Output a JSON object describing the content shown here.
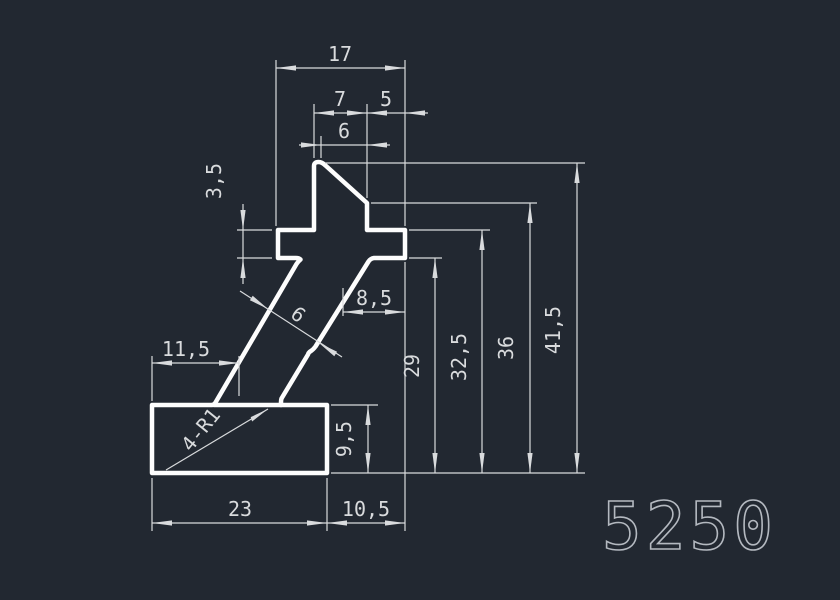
{
  "drawing": {
    "part_number": "5250",
    "colors": {
      "background": "#222831",
      "profile": "#fdfdfd",
      "dimension": "#d9dbdd",
      "part_number": "#b4b9c0"
    },
    "dimension_labels": [
      {
        "id": "dim-17",
        "label": "17",
        "x": 340,
        "y": 61,
        "rot": 0
      },
      {
        "id": "dim-7",
        "label": "7",
        "x": 340,
        "y": 106,
        "rot": 0
      },
      {
        "id": "dim-5",
        "label": "5",
        "x": 386,
        "y": 106,
        "rot": 0
      },
      {
        "id": "dim-6-top",
        "label": "6",
        "x": 344,
        "y": 138,
        "rot": 0
      },
      {
        "id": "dim-3-5",
        "label": "3,5",
        "x": 221,
        "y": 181,
        "rot": -90
      },
      {
        "id": "dim-8-5",
        "label": "8,5",
        "x": 374,
        "y": 305,
        "rot": 0
      },
      {
        "id": "dim-11-5",
        "label": "11,5",
        "x": 186,
        "y": 356,
        "rot": 0
      },
      {
        "id": "dim-9-5",
        "label": "9,5",
        "x": 351,
        "y": 439,
        "rot": -90
      },
      {
        "id": "dim-29",
        "label": "29",
        "x": 419,
        "y": 366,
        "rot": -90
      },
      {
        "id": "dim-32-5",
        "label": "32,5",
        "x": 466,
        "y": 357,
        "rot": -90
      },
      {
        "id": "dim-36",
        "label": "36",
        "x": 513,
        "y": 348,
        "rot": -90
      },
      {
        "id": "dim-41-5",
        "label": "41,5",
        "x": 560,
        "y": 330,
        "rot": -90
      },
      {
        "id": "dim-23",
        "label": "23",
        "x": 240,
        "y": 516,
        "rot": 0
      },
      {
        "id": "dim-10-5",
        "label": "10,5",
        "x": 366,
        "y": 516,
        "rot": 0
      },
      {
        "id": "dim-strut-6",
        "label": "6",
        "x": 294,
        "y": 320,
        "rot": 38
      },
      {
        "id": "dim-corner-radius",
        "label": "4-R1",
        "x": 206,
        "y": 434,
        "rot": -51
      }
    ]
  }
}
